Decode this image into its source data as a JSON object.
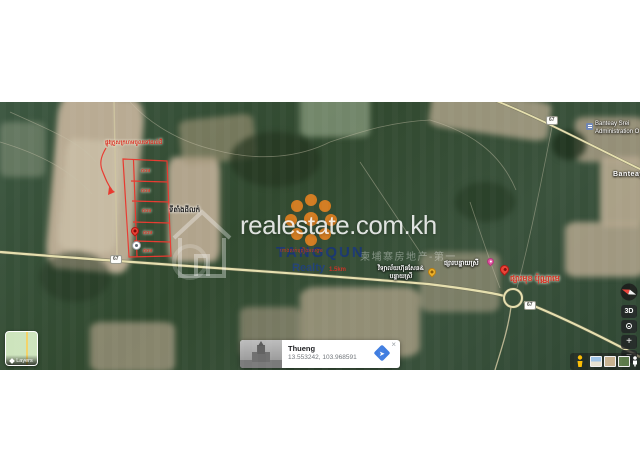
{
  "watermark": {
    "site": "realestate.com.kh",
    "cn_row": "柬埔寨房地产-第一",
    "agency": "TANGQUN",
    "agency_overlay": "ហាងលក់គ្រឿងអលង្ការ",
    "realty": "Realty",
    "distance": "1.5km"
  },
  "property": {
    "note": "ផ្លូវក្រួសក្រហមចូលទៅដល់ដី",
    "location_label": "ទីតាំងដីលក់",
    "plots": [
      "៥០ម",
      "៥០ម",
      "៥០ម",
      "៥០ម",
      "៥០ម"
    ]
  },
  "pois": {
    "market": "ផ្សារបន្ទាយស្រី",
    "school_line1": "វិទ្យាល័យហ៊ុនសែន&",
    "school_line2": "បន្ទាយស្រី",
    "red_place": "ផ្សារមុខ ប៉ុណ្ណាមេ",
    "admin_line1": "Banteay Srei",
    "admin_line2": "Administration O",
    "district": "Banteay S",
    "route_badge": "67"
  },
  "controls": {
    "threed": "3D",
    "zoom_in": "+",
    "zoom_out": "−",
    "layers": "Layers"
  },
  "infocard": {
    "title": "Thueng",
    "coordinates": "13.553242, 103.968591",
    "close": "×"
  }
}
